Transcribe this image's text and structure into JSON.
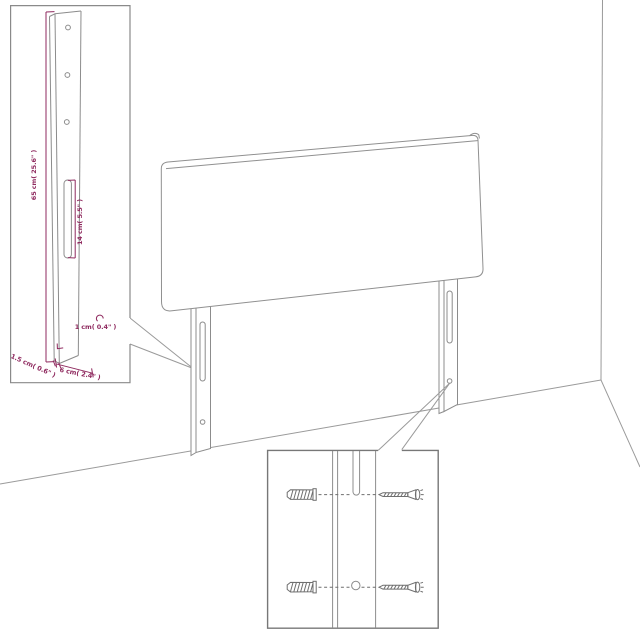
{
  "scene": {
    "description": "Assembly diagram of an upholstered headboard with two slotted leg posts standing in a wall corner, with a leg-dimension detail inset and a wall-plug/screw hardware inset",
    "background_color": "#ffffff",
    "line_color": "#8c8c8c",
    "dimension_color": "#8f2a5f"
  },
  "leg_detail_inset": {
    "height_label": "65 cm( 25.6\" )",
    "slot_label": "14 cm( 5.5\" )",
    "hole_label": "1 cm( 0.4\" )",
    "thickness_label": "1.5 cm( 0.6\" )",
    "width_label": "6 cm( 2.4\" )",
    "hole_count": 3
  },
  "hardware_inset": {
    "row_count": 2,
    "left_icon": "wall-plug",
    "right_icon": "screw"
  }
}
